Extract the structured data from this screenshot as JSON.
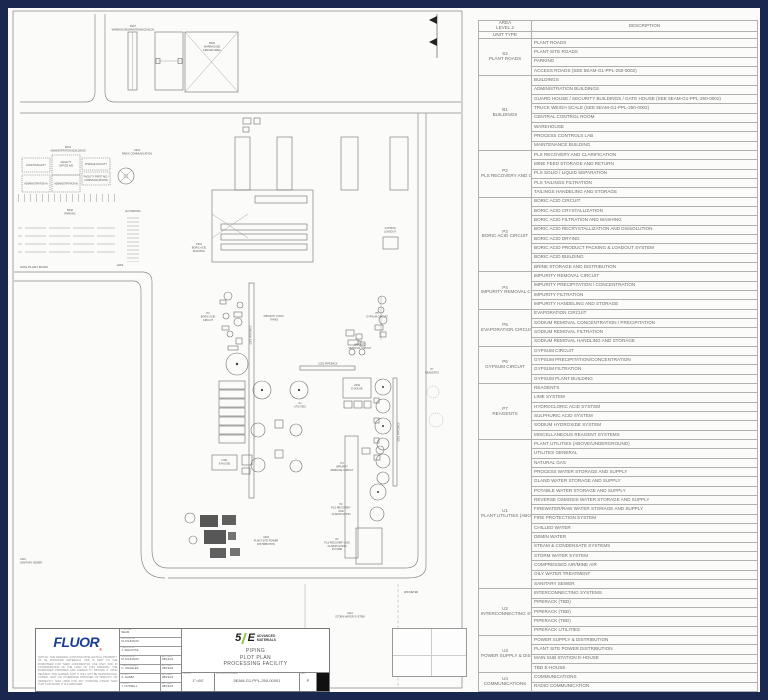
{
  "legend_table": {
    "header": {
      "area_line1": "AREA",
      "area_line2": "LEVEL 2",
      "unit_type": "UNIT TYPE",
      "description": "DESCRIPTION"
    },
    "groups": [
      {
        "code": "S2",
        "name": "PLANT ROADS",
        "rows": [
          "PLANT ROADS",
          "PLANT SITE ROADS",
          "PARKING",
          "ACCESS ROADS (SEE 5EAM-G1-PPL-250-0002)"
        ]
      },
      {
        "code": "B1",
        "name": "BUILDINGS",
        "rows": [
          "BUILDINGS",
          "ADMINISTRATION BUILDINGS",
          "GUARD HOUSE / SECURITY BUILDINGS / GATE HOUSE (SEE 5EAM-G1-PPL-250-0002)",
          "TRUCK WEIGH SCALE (SEE 5EAM-G1-PPL-250-0002)",
          "CENTRAL CONTROL ROOM",
          "WAREHOUSE",
          "PROCESS CONTROLS LAB",
          "MAINTENANCE BUILDING"
        ]
      },
      {
        "code": "P2",
        "name": "PLS RECOVERY AND CLARIFICATION",
        "rows": [
          "PLS RECOVERY AND CLARIFICATION",
          "MINE FEED STORAGE AND RETURN",
          "PLS SOLID / LIQUID SEPARATION",
          "PLS TAILINGS FILTRATION",
          "TAILINGS HANDELING AND STORAGE"
        ]
      },
      {
        "code": "P3",
        "name": "BORIC ACID CIRCUIT",
        "rows": [
          "BORIC ACID CIRCUIT",
          "BORIC ACID CRYSTALLIZATION",
          "BORIC ACID FILTRATION AND WASHING",
          "BORIC ACID RECRYSTALLIZATION AND DISSOLUTION",
          "BORIC ACID DRYING",
          "BORIC ACID PRODUCT PACKING & LOADOUT SYSTEM",
          "BORIC ACID BUILDING",
          "BRINE STORAGE AND DISTRIBUTION"
        ]
      },
      {
        "code": "P4",
        "name": "IMPURITY REMOVAL CIRCUIT",
        "rows": [
          "IMPURITY REMOVAL CIRCUIT",
          "IMPURITY PRECIPITATION / CONCENTRATION",
          "IMPURITY FILTRATION",
          "IMPURITY HANDELING AND STORAGE"
        ]
      },
      {
        "code": "P5",
        "name": "EVAPORATION CIRCUIT",
        "rows": [
          "EVAPORATION CIRCUIT",
          "SODIUM REMOVAL CONCENTRATION / PRECIPITATION",
          "SODIUM REMOVAL FILTRATION",
          "SODIUM REMOVAL HANDLING AND STORAGE"
        ]
      },
      {
        "code": "P6",
        "name": "GYPSUM CIRCUIT",
        "rows": [
          "GYPSUM CIRCUIT",
          "GYPSUM PRECIPITATION/CONCENTRATION",
          "GYPSUM FILTRATION",
          "GYPSUM PLANT BUILDING"
        ]
      },
      {
        "code": "P7",
        "name": "REAGENTS",
        "rows": [
          "REAGENTS",
          "LIME SYSTEM",
          "HYDROCLORIC ACID SYSTEM",
          "SULPHURIC ACID SYSTEM",
          "SODIUM HYDROXIDE SYSTEM",
          "MISCELLANEOUS REAGENT SYSTEMS"
        ]
      },
      {
        "code": "U1",
        "name": "PLANT UTILITIES (ABOVE/ UNDERGROUND)",
        "rows": [
          "PLANT UTILITIES (ABOVE/UNDERGROUND)",
          "UTILITES GENERAL",
          "NATURAL GAS",
          "PROCESS WATER STORAGE AND SUPPLY",
          "GLAND WATER STORAGE AND SUPPLY",
          "POTABLE WATER STORAGE AND SUPPLY",
          "REVERSE OSMOSIS WATER STORAGE AND SUPPLY",
          "FIREWATER/RAW WATER STORAGE AND SUPPLY",
          "FIRE PROTECTION SYSTEM",
          "CHILLED WATER",
          "DEMIN WATER",
          "STEAM & CONDENSATE SYSTEMS",
          "STORM WATER SYSTEM",
          "COMPRESSED AIR/MINE AIR",
          "OILY WATER TREATMENT",
          "SANITARY SEWER"
        ]
      },
      {
        "code": "U2",
        "name": "INTERCONNECTING SYSTEMS",
        "rows": [
          "INTERCONNECTING SYSTEMS",
          "PIPERACK (TBD)",
          "PIPERACK (TBD)",
          "PIPERACK (TBD)",
          "PIPERACK UTILITIES"
        ]
      },
      {
        "code": "U3",
        "name": "POWER SUPPLY & DISTRIBUTION",
        "rows": [
          "POWER SUPPLY & DISTRIBUTION",
          "PLANT SITE POWER DISTRIBUTION",
          "MAIN SUB STATION E-HOUSE",
          "TBD E-HOUSE"
        ]
      },
      {
        "code": "U4",
        "name": "COMMUNICATIONS",
        "rows": [
          "COMMUNICATIONS",
          "RADIO COMMUNICATION"
        ]
      }
    ]
  },
  "drawing": {
    "labels": {
      "b107": [
        "B107",
        "WAREHOUSE/MAINTENANCE BLDG"
      ],
      "b106": [
        "B106",
        "WAREHOUSE",
        "FENCED AREA"
      ],
      "b101": [
        "B101",
        "ADMINISTRATION BUILDINGS"
      ],
      "lunch": "LUNCH FACILITY",
      "office": [
        "FACILITY",
        "OFFICE A/B"
      ],
      "change": "CHANGE FACILITY",
      "admin_a": "ADMINISTRATION A",
      "admin_b": "ADMINISTRATION B",
      "first_aid": [
        "FACILITY FIRST AID /",
        "COMMUNICATIONS"
      ],
      "radio": [
        "U401",
        "RADIO COMMUNICATION"
      ],
      "ev_parking": "EV PARKING",
      "b102": [
        "B102",
        "PARKING"
      ],
      "s201": "S201 PLANT ROAD",
      "gate": "GATE",
      "p301": [
        "P301",
        "BORIC ACID",
        "BUILDING"
      ],
      "p3": [
        "P3",
        "BORIC ACID",
        "CIRCUIT"
      ],
      "u203": "U203 PIPERACK",
      "imp_conc": [
        "IMPURITY CONC.",
        "TANKS"
      ],
      "gypsum_loadout": [
        "GYPSUM",
        "LOADOUT"
      ],
      "p6": [
        "P6",
        "GYPSUM CIRCUIT"
      ],
      "p4_top": [
        "P4",
        "IMPURITY",
        "REMOVAL CIRCUIT"
      ],
      "u202": "U202 PIPERACK",
      "u302": [
        "U302",
        "E-HOUSE"
      ],
      "p7": [
        "P7",
        "REAGENTS"
      ],
      "u201": "U201 PIPERACK",
      "u1": [
        "U1",
        "UTILITIES"
      ],
      "u301": [
        "U301",
        "E-HOUSE"
      ],
      "u303": [
        "U303",
        "PLANT SITE POWER",
        "DISTRIBUTION"
      ],
      "p4_bottom": [
        "P4",
        "IMPURITY",
        "REMOVAL CIRCUIT"
      ],
      "p2": [
        "P2",
        "PLS RECOVERY",
        "AND",
        "CLARIFICATION"
      ],
      "p2_future": [
        "P2",
        "PLS RECOVERY AND",
        "CLARIFICATION",
        "FUTURE"
      ],
      "u112": [
        "U112",
        "STORM WATER SYSTEM"
      ],
      "ww_meter": "WW METER",
      "u110": [
        "U110",
        "SANITARY SEWER"
      ]
    }
  },
  "title_block": {
    "fluor": "FLUOR",
    "registered": "®",
    "notice": "NOTICE: THIS DRAWING CONTAINS INTELLECTUAL PROPERTY OF 5E ADVANCED MATERIALS, AND IS LENT TO THE BORROWER FOR THEIR CONFIDENTIAL USE ONLY, AND IN CONSIDERATION OF THE LOAN OF THIS DRAWING, THE BORROWER PROMISES AND AGREES TO RETURN IT UPON REQUEST AND AGREES THAT IT WILL NOT BE REPRODUCED, COPIED, LENT OR OTHERWISE DISPOSED OF DIRECTLY OR INDIRECTLY, NOR USED FOR ANY PURPOSE OTHER THAN THAT FOR WHICH IT IS FURNISHED.",
    "rows": [
      {
        "label": "CONTRACT",
        "value": "5EAM"
      },
      {
        "label": "DESIGNED BY",
        "value": "M.JOHNSON"
      },
      {
        "label": "CHECKED BY",
        "value": "J. WALDYKE"
      },
      {
        "label": "SUPERVISOR",
        "value": "M.JOHNSON",
        "date_label": "APP DATE",
        "date": "08/19/24"
      },
      {
        "label": "LEAD ENGINEER",
        "value": "C. ANGELES",
        "date_label": "APP DATE",
        "date": "08/19/24"
      },
      {
        "label": "FLUOR",
        "value": "A. HAMM",
        "date_label": "APP DATE",
        "date": "08/19/24"
      },
      {
        "label": "CLIENT",
        "value": "J. FUSSELL",
        "date_label": "APP DATE",
        "date": "08/19/24"
      }
    ],
    "logo_5e": {
      "five": "5",
      "e": "E",
      "line1": "ADVANCED",
      "line2": "MATERIALS"
    },
    "title_lines": [
      "PIPING",
      "PLOT PLAN",
      "PROCESSING FACILITY"
    ],
    "scale_label": "SCALE",
    "scale": "1\"=60'",
    "drawing_number_label": "DRAWING NUMBER",
    "drawing_number": "5EAM-G1-PPL-250-00001",
    "rev_label": "REV",
    "rev": "P"
  },
  "colors": {
    "frame": "#1c2750",
    "paper": "#fbfbfa",
    "fluor_blue": "#1a3e96",
    "logo_green": "#8fc63e",
    "line_gray": "#6f6f6f"
  }
}
